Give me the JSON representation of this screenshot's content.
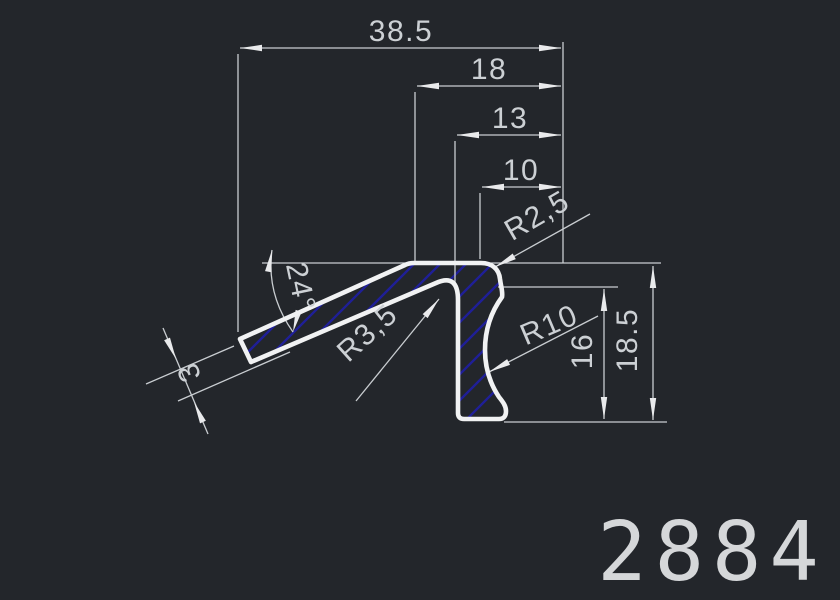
{
  "drawing": {
    "part_number": "2884",
    "dimensions": {
      "overall_width": "38.5",
      "step_18": "18",
      "step_13": "13",
      "step_10": "10",
      "height_overall": "18.5",
      "height_lip_to_base": "16",
      "arm_thickness": "3",
      "arm_angle": "24°",
      "radius_top_corner": "R2,5",
      "radius_cove": "R10",
      "radius_inner_fillet": "R3,5"
    },
    "colors": {
      "background": "#23262b",
      "outline": "#f1f2f3",
      "dimension_lines": "#c9cdd1",
      "hatch": "#1f1f97",
      "text": "#ccd0d4",
      "part_number_color": "#d5d7d9"
    }
  }
}
